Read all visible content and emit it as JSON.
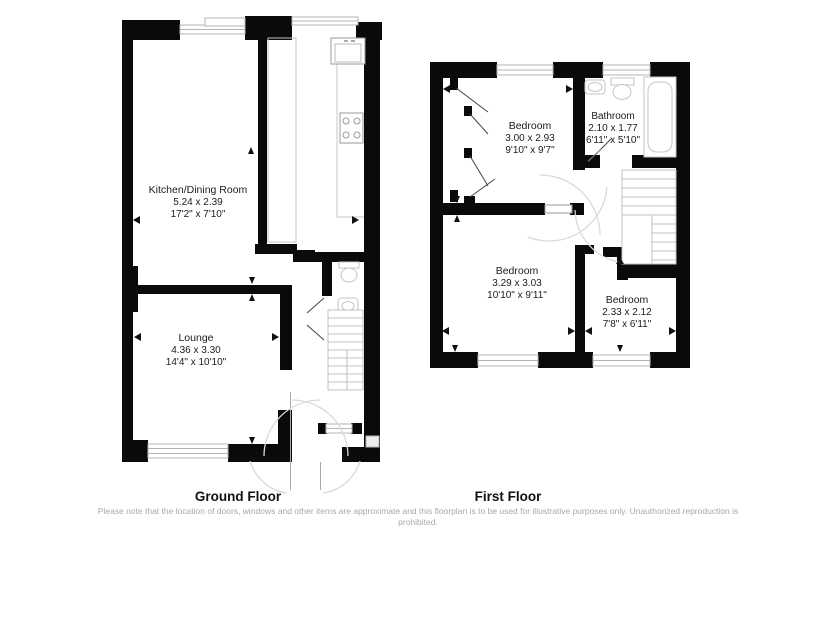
{
  "ground_floor": {
    "title": "Ground Floor",
    "rooms": [
      {
        "name": "Kitchen/Dining Room",
        "metric": "5.24 x 2.39",
        "imperial": "17'2\" x 7'10\""
      },
      {
        "name": "Lounge",
        "metric": "4.36 x 3.30",
        "imperial": "14'4\" x 10'10\""
      }
    ]
  },
  "first_floor": {
    "title": "First Floor",
    "rooms": [
      {
        "name": "Bedroom",
        "metric": "3.00 x 2.93",
        "imperial": "9'10\" x 9'7\""
      },
      {
        "name": "Bathroom",
        "metric": "2.10 x 1.77",
        "imperial": "6'11\" x 5'10\""
      },
      {
        "name": "Bedroom",
        "metric": "3.29 x 3.03",
        "imperial": "10'10\" x 9'11\""
      },
      {
        "name": "Bedroom",
        "metric": "2.33 x 2.12",
        "imperial": "7'8\" x 6'11\""
      }
    ]
  },
  "disclaimer": "Please note that the location of doors, windows and other items are approximate and this floorplan is to be used for illustrative purposes only. Unauthorized reproduction is prohibited.",
  "colors": {
    "wall": "#0a0a0a",
    "fixture": "#c4c4c4",
    "arc": "#d9d9d9",
    "text": "#1c1c1c"
  }
}
